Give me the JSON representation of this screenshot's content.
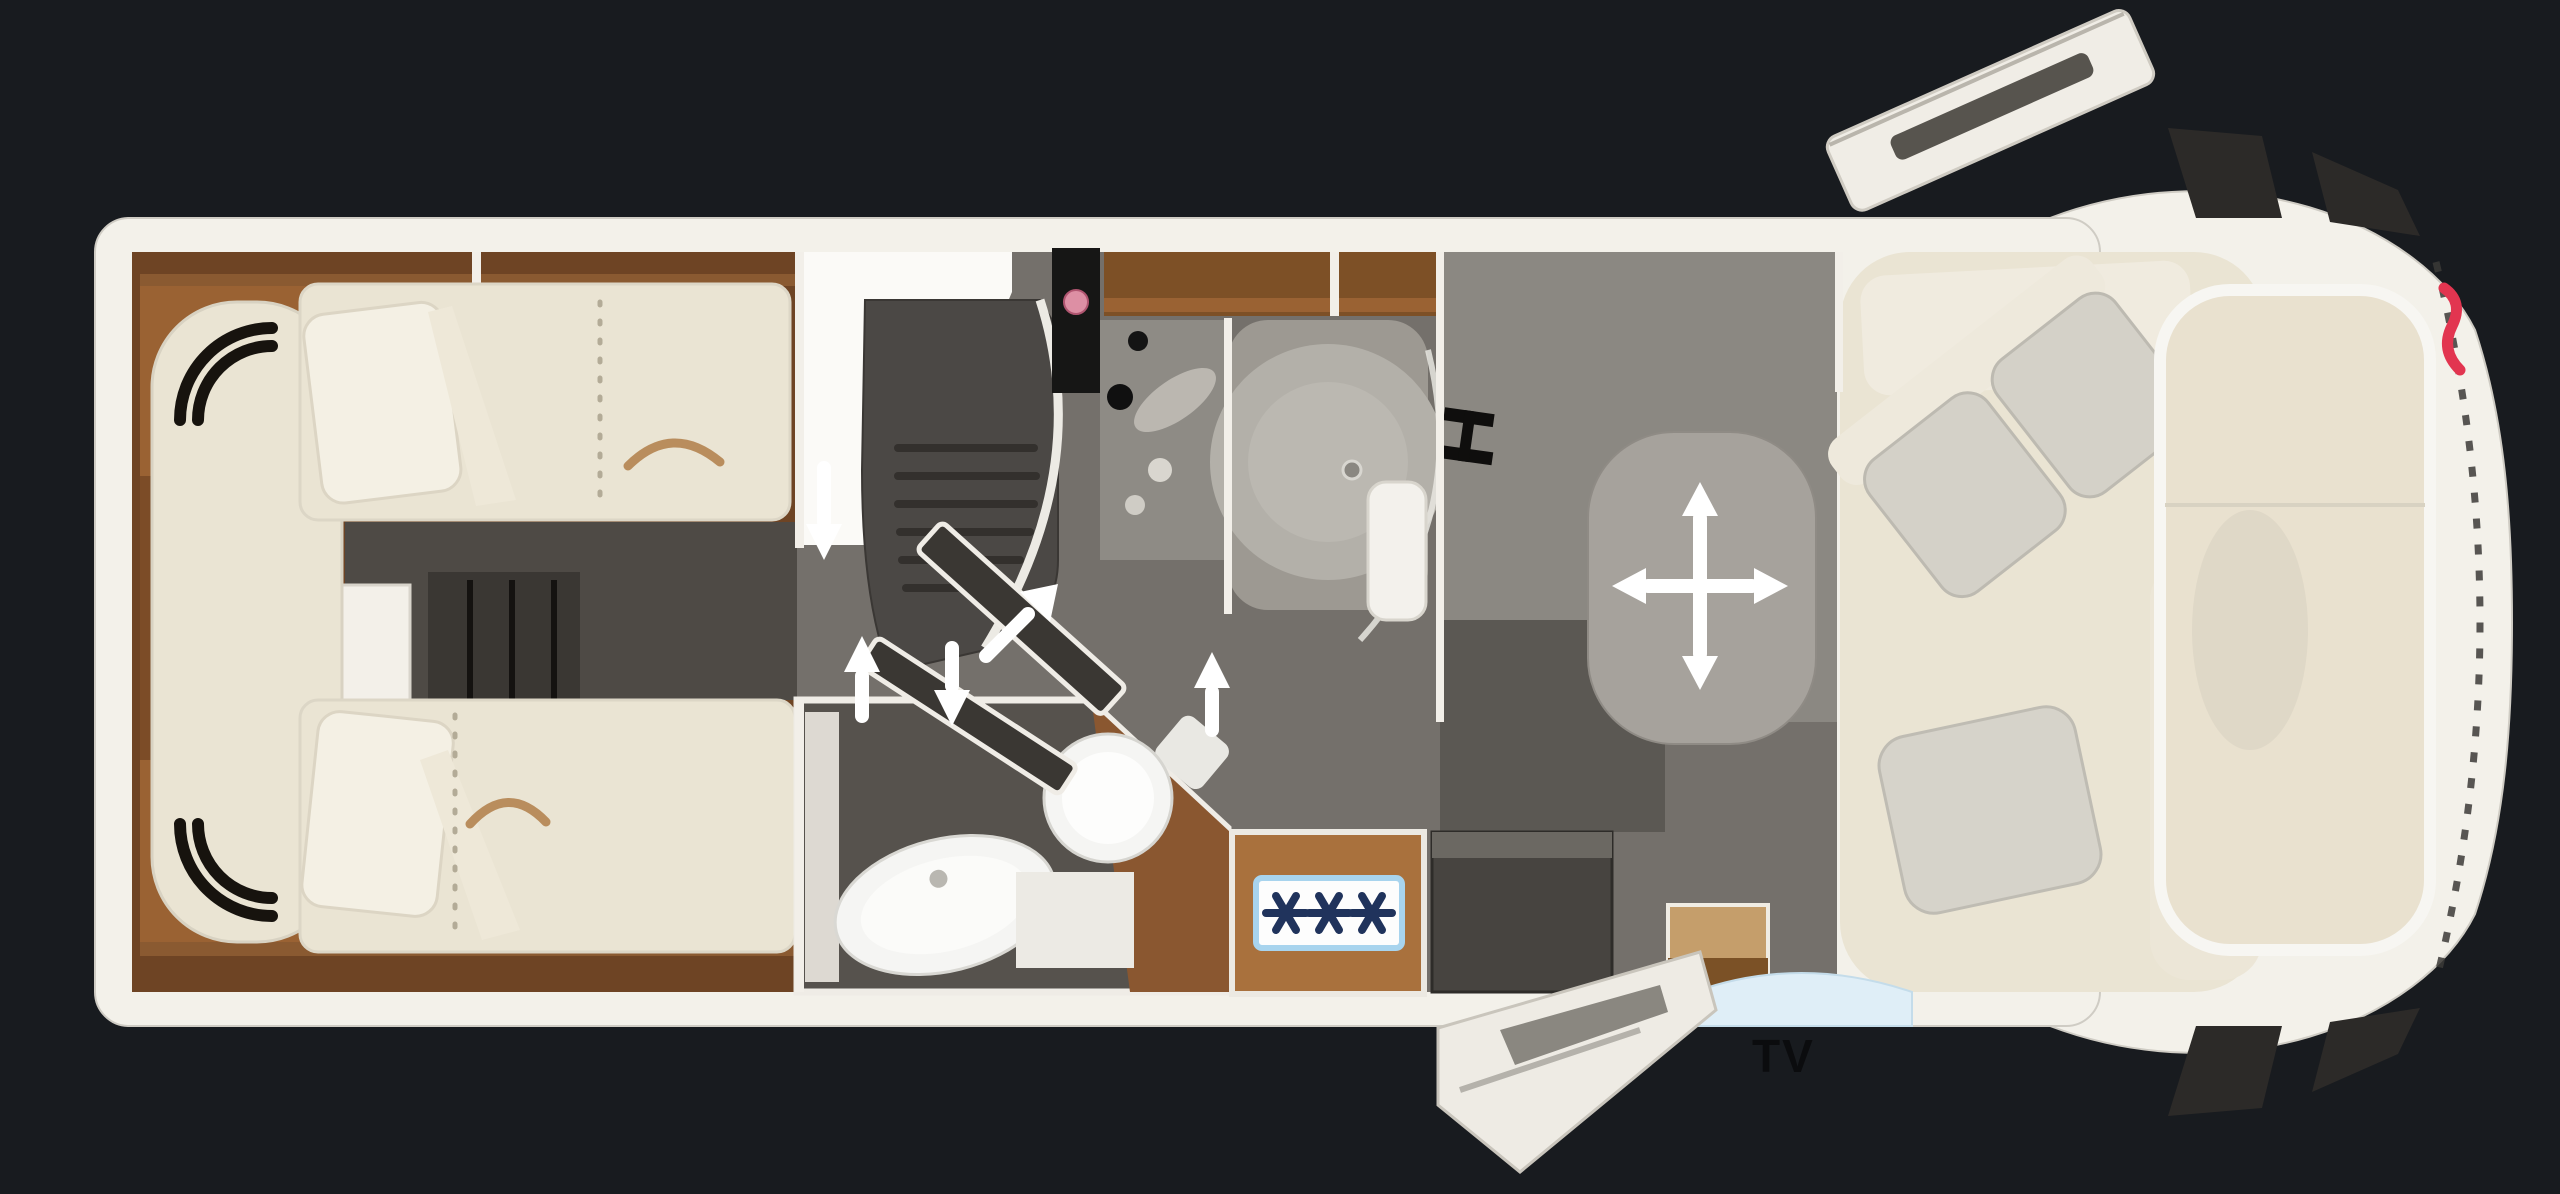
{
  "scene": {
    "name": "motorhome-floorplan-top-view",
    "width": 2560,
    "height": 1194
  },
  "labels": {
    "tv": "TV"
  },
  "colors": {
    "background": "#181b1f",
    "hull": "#f3f1ea",
    "wood_dark": "#6e4424",
    "wood": "#8a5730",
    "wood_light": "#a9713d",
    "wood_band": "#7d5026",
    "wood_band_light": "#9a6233",
    "upholstery": "#eae4d3",
    "upholstery_light": "#f4f0e4",
    "cushion_gray": "#d4d1c8",
    "floor_gray": "#74706b",
    "floor_dark": "#56524d",
    "aisle_dark": "#4e4a45",
    "kitchen_block": "#4b4845",
    "counter_black": "#161615",
    "counter_gray": "#8e8b85",
    "shower": "#9d9992",
    "shower_inner": "#b3b0a9",
    "wall_gray": "#8b8882",
    "wall_gray_dark": "#5b5853",
    "table_gray": "#a6a29c",
    "fixture_white": "#f5f5f3",
    "closet_dark": "#3a3733",
    "fridge_dark": "#474440",
    "stove_panel": "#fdfdfd",
    "stove_border": "#a8d4ee",
    "burner_star": "#20335c",
    "red_dot": "#dd8fa4",
    "brand_red": "#e23550",
    "door_white": "#f0ede6",
    "door_slot": "#57544e",
    "step_white": "#eeebe4",
    "step_slot": "#8a8780",
    "mirror_dark": "#2c2a28",
    "windshield": "#e9e1cf",
    "skylight_blue": "#dfeef7",
    "tv_text": "#0b0c0e",
    "arrow_white": "#ffffff"
  },
  "elements": [
    "rear-twin-beds",
    "bed-corner-trim",
    "between-bed-closet",
    "kitchen-block",
    "kitchen-sink-counter",
    "shower-cabin",
    "wardrobe-tv-wall",
    "tv-mount-bracket",
    "washroom-toilet",
    "washroom-basin",
    "gas-hob-3-burner",
    "fridge-cabinet",
    "sideboard",
    "dinette-table",
    "table-move-icon",
    "lounge-sofa",
    "driver-cab-windshield",
    "side-mirrors",
    "entry-door-open",
    "entry-step-open",
    "door-swing-panels",
    "direction-arrows",
    "brand-logo-red"
  ]
}
